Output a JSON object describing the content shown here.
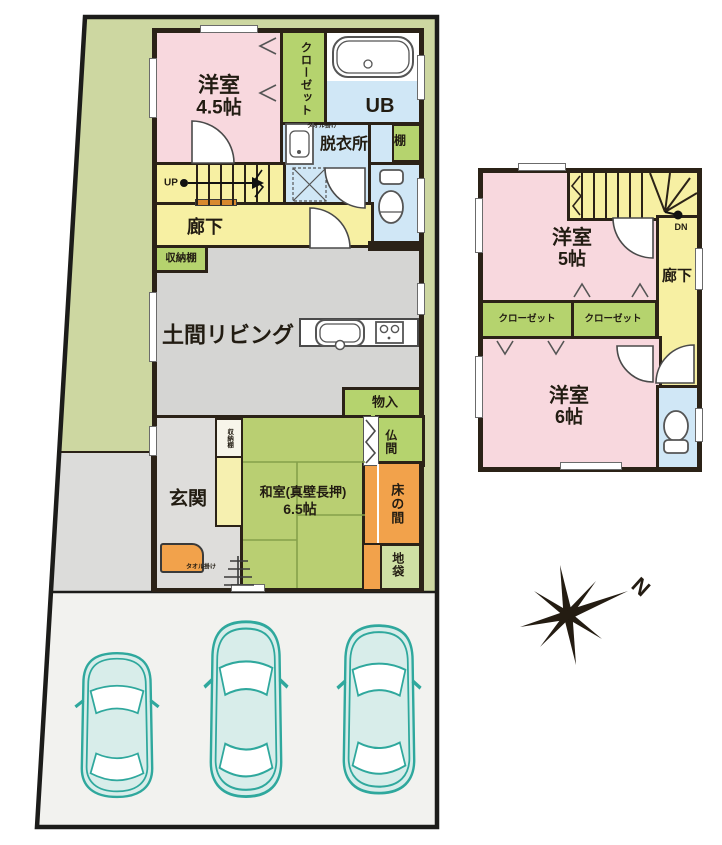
{
  "floor1": {
    "bedroom": {
      "name": "洋室",
      "size": "4.5帖"
    },
    "closet": "クローゼット",
    "bath": "UB",
    "dressing_room": "脱衣所",
    "shelf": "棚",
    "stairs_up": "UP",
    "hallway": "廊下",
    "storage_shelf_top": "収納棚",
    "living": "土間リビング",
    "storage": "物入",
    "altar_room": "仏間",
    "alcove": "床の間",
    "floor_cabinet": "地袋",
    "japanese_room": {
      "name": "和室(真壁長押)",
      "size": "6.5帖"
    },
    "storage_shelf_side": "収納棚",
    "entrance": "玄関",
    "towel_rack_dressing": "タオル掛け",
    "towel_rack_entrance": "タオル掛け"
  },
  "floor2": {
    "bedroom_small": {
      "name": "洋室",
      "size": "5帖"
    },
    "stairs_down": "DN",
    "hallway": "廊下",
    "closet_left": "クローゼット",
    "closet_right": "クローゼット",
    "bedroom_large": {
      "name": "洋室",
      "size": "6帖"
    }
  },
  "compass": {
    "label": "N"
  },
  "colors": {
    "wall": "#2b2217",
    "site_green": "#cdd7a1",
    "room_pink": "#f8d8de",
    "corridor_yellow": "#f7f0a3",
    "closet_green": "#b5d36e",
    "wet_blue": "#d0e7f6",
    "tatami_green": "#b9cf72",
    "alcove_orange": "#f2a24b",
    "living_gray": "#d5d5d3",
    "entrance_gray": "#dedddb",
    "parking_gray": "#f2f2ef",
    "car_teal": "#2fa89d",
    "handrail_orange": "#d8892e"
  }
}
